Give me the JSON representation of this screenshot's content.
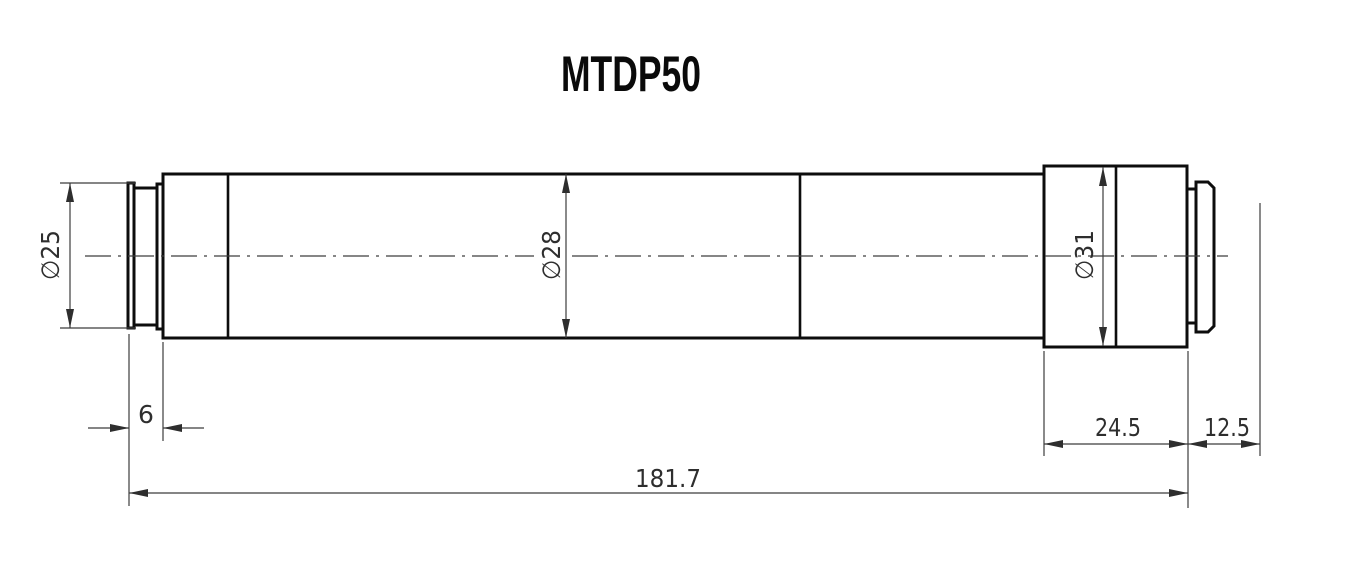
{
  "title": "MTDP50",
  "part": {
    "type": "lens-technical-drawing",
    "dimension_labels": {
      "diameter_front": "∅25",
      "diameter_body": "∅28",
      "diameter_mount": "∅31",
      "front_ring_length": "6",
      "mount_length": "24.5",
      "back_distance": "12.5",
      "overall_length": "181.7"
    },
    "dimension_values_mm": {
      "diameter_front": 25,
      "diameter_body": 28,
      "diameter_mount": 31,
      "front_ring_length": 6,
      "mount_length": 24.5,
      "back_distance": 12.5,
      "overall_length": 181.7
    },
    "colors": {
      "background": "#ffffff",
      "outline": "#0d0d0d",
      "dimension_lines": "#3c3c3c",
      "text": "#2e2e2e"
    }
  }
}
